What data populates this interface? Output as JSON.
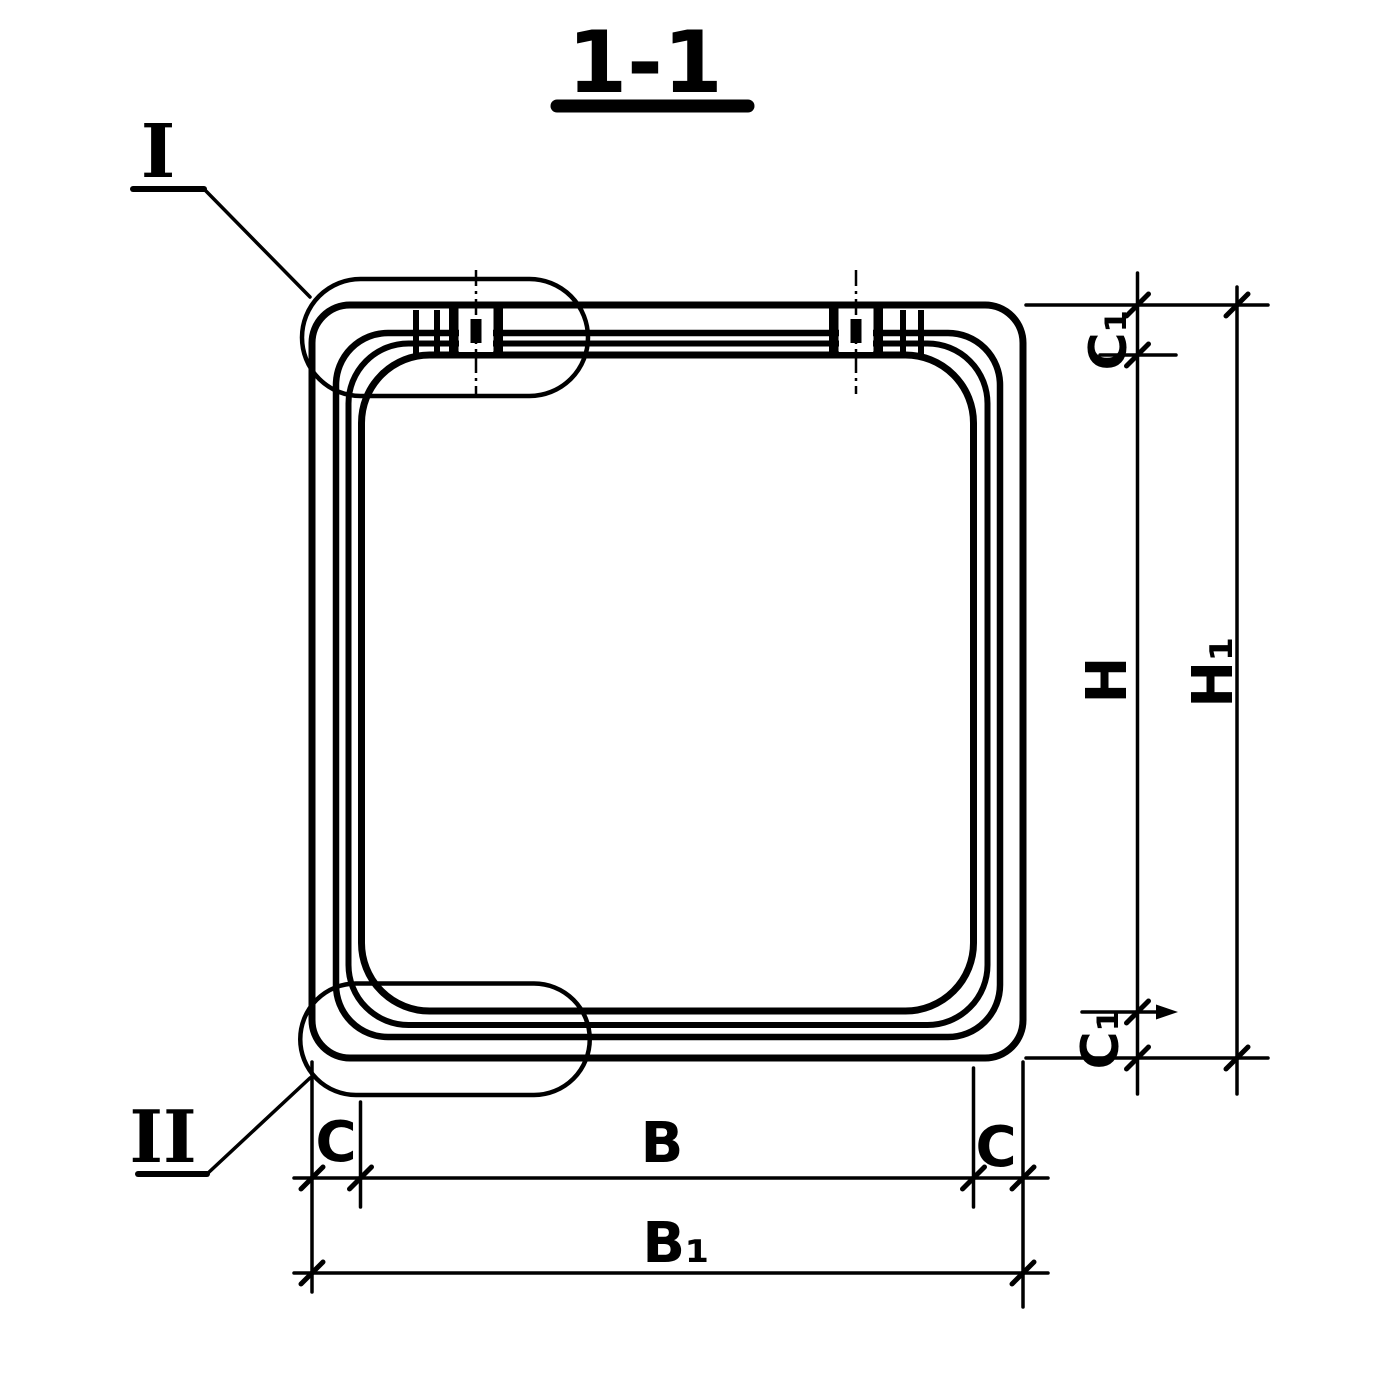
{
  "page": {
    "background": "#ffffff",
    "ink": "#000000"
  },
  "title": {
    "text": "1-1"
  },
  "details": {
    "top": {
      "label": "I"
    },
    "bottom": {
      "label": "II"
    }
  },
  "dimensions": {
    "c1_top": "C₁",
    "h": "H",
    "h1": "H₁",
    "c1_bottom": "C₁",
    "c_left": "C",
    "b": "B",
    "c_right": "C",
    "b1": "B₁"
  }
}
